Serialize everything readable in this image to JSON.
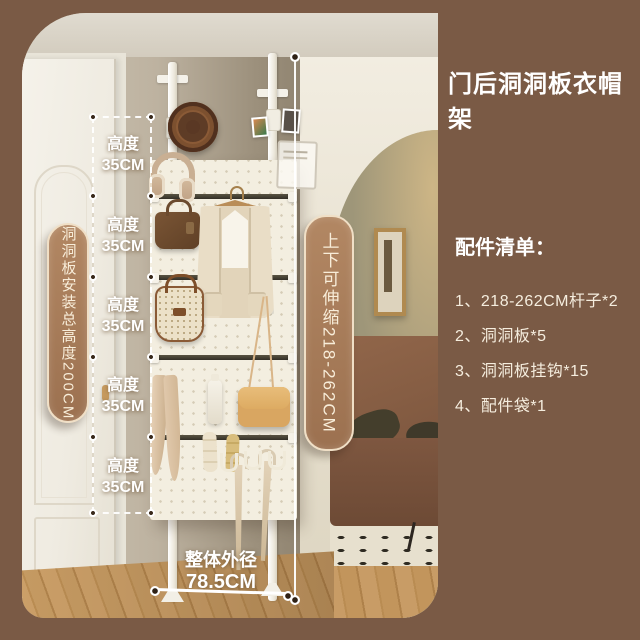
{
  "title": "门后洞洞板衣帽架",
  "accessories": {
    "heading": "配件清单：",
    "items": [
      "1、218-262CM杆子*2",
      "2、洞洞板*5",
      "3、洞洞板挂钩*15",
      "4、配件袋*1"
    ]
  },
  "annotations": {
    "left_pill": "洞洞板安装总高度200CM",
    "middle_pill": "上下可伸缩218-262CM",
    "segment_label_line1": "高度",
    "segment_label_line2": "35CM",
    "segment_count": 5,
    "bottom_label_line1": "整体外径",
    "bottom_label_line2": "78.5CM"
  },
  "colors": {
    "background": "#7a5a45",
    "pill_fill": "#9c7150",
    "pill_border": "#f0dfc6",
    "pill_text": "#f8edd9",
    "list_text": "#f5edde",
    "pegboard": "#f3eee0",
    "rail": "#332f27",
    "sofa": "#7c563e",
    "interior_wall": "#9e9679",
    "wood_floor": "#c59a62"
  }
}
